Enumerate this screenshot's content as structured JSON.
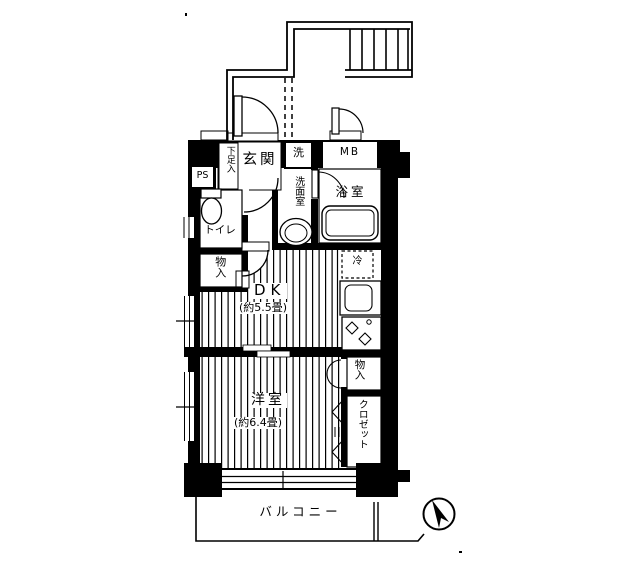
{
  "plan": {
    "labels": {
      "shoe_storage": "下足入",
      "entrance": "玄関",
      "washer": "洗",
      "meter_box": "MB",
      "pipe_space": "PS",
      "toilet": "トイレ",
      "storage_hall": "物入",
      "washroom": "洗面室",
      "bathroom": "浴室",
      "refrigerator": "冷",
      "dk_name": "DK",
      "dk_size": "(約5.5畳)",
      "western_name": "洋室",
      "western_size": "(約6.4畳)",
      "storage_bedroom": "物入",
      "closet": "クロゼット",
      "balcony": "バルコニー"
    },
    "colors": {
      "line": "#000000",
      "background": "#ffffff"
    }
  }
}
